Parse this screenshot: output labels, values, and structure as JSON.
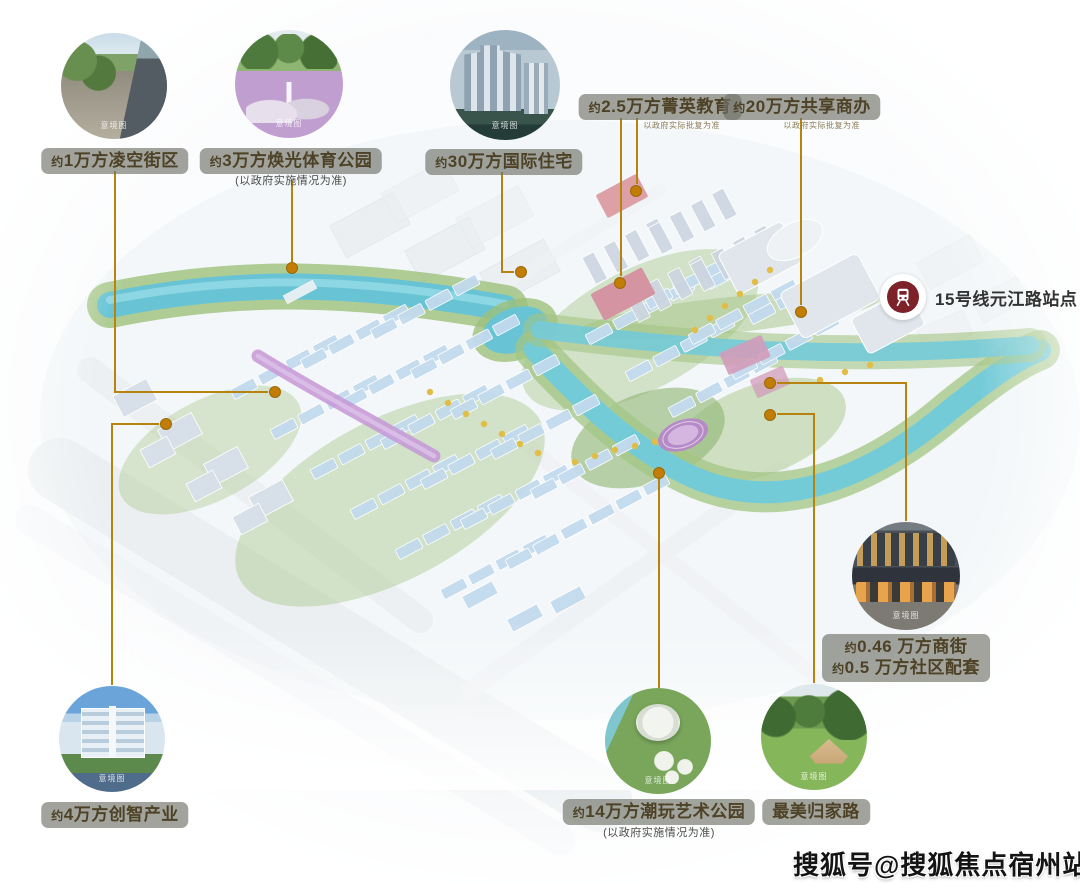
{
  "colors": {
    "accent_line": "#b5830e",
    "dot": "#c17d06",
    "pill_bg": "rgba(112,114,105,0.65)",
    "pill_text": "#4d4226",
    "station_icon": "#7c2228"
  },
  "watermark": {
    "text": "搜狐号@搜狐焦点宿州站"
  },
  "station": {
    "label": "15号线元江路站点"
  },
  "callouts": [
    {
      "id": "lingkong-street",
      "label": "约1万方凌空街区",
      "caption": "意境图"
    },
    {
      "id": "sports-park",
      "label": "约3万方焕光体育公园",
      "note": "(以政府实施情况为准)",
      "caption": "意境图"
    },
    {
      "id": "intl-residence",
      "label": "约30万方国际住宅",
      "caption": "意境图"
    },
    {
      "id": "elite-education",
      "label": "约2.5万方菁英教育",
      "note": "以政府实际批复为准"
    },
    {
      "id": "shared-office",
      "label": "约20万方共享商办",
      "note": "以政府实际批复为准"
    },
    {
      "id": "shop-street",
      "label_line1": "约0.46 万方商街",
      "label_line2": "约0.5 万方社区配套",
      "caption": "意境图"
    },
    {
      "id": "art-park",
      "label": "约14万方潮玩艺术公园",
      "note": "(以政府实施情况为准)",
      "caption": "意境图"
    },
    {
      "id": "home-road",
      "label": "最美归家路",
      "caption": "意境图"
    },
    {
      "id": "smart-industry",
      "label": "约4万方创智产业",
      "caption": "意境图"
    }
  ]
}
